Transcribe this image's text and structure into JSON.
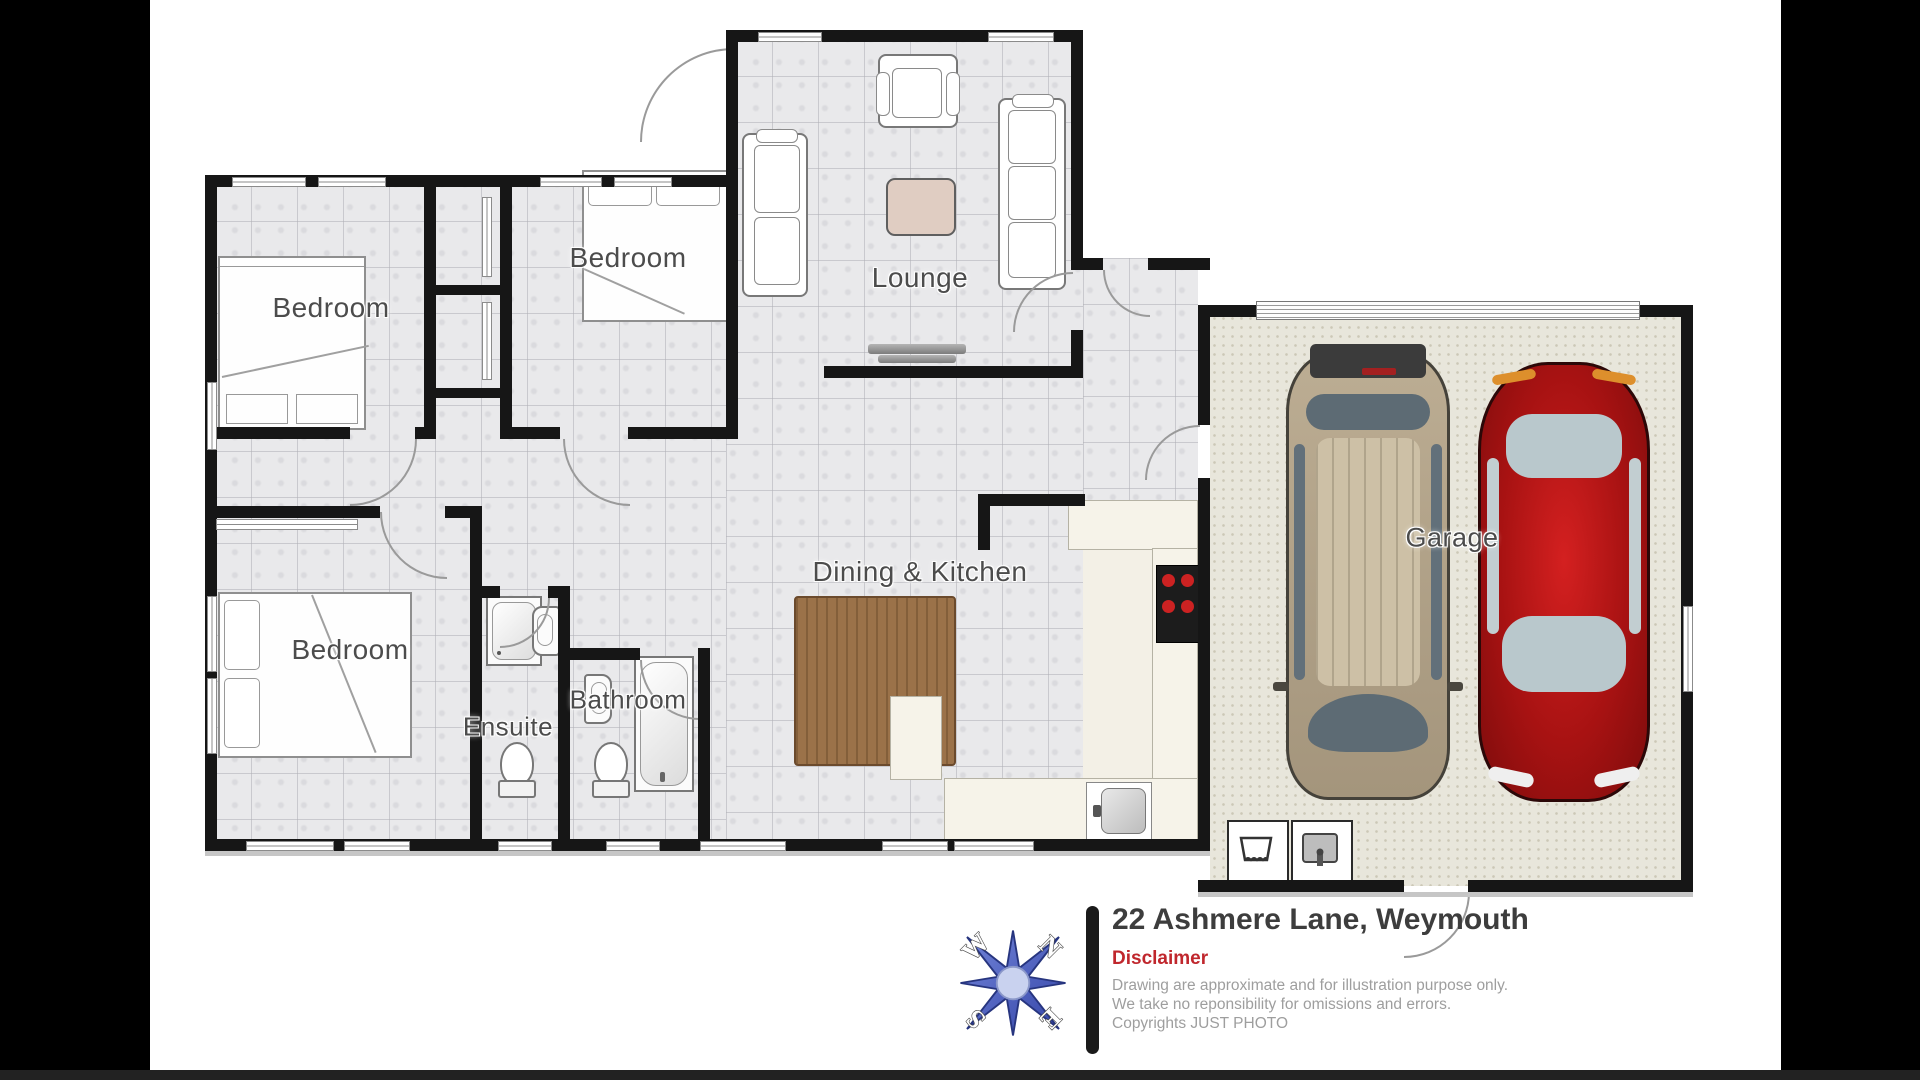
{
  "floorplan": {
    "rooms": [
      {
        "id": "bedroom-1",
        "label": "Bedroom"
      },
      {
        "id": "bedroom-2",
        "label": "Bedroom"
      },
      {
        "id": "lounge",
        "label": "Lounge"
      },
      {
        "id": "bedroom-3",
        "label": "Bedroom"
      },
      {
        "id": "ensuite",
        "label": "Ensuite"
      },
      {
        "id": "bathroom",
        "label": "Bathroom"
      },
      {
        "id": "dining-kitchen",
        "label": "Dining & Kitchen"
      },
      {
        "id": "garage",
        "label": "Garage"
      }
    ]
  },
  "compass": {
    "n": "N",
    "e": "E",
    "s": "S",
    "w": "W"
  },
  "footer": {
    "address": "22 Ashmere Lane, Weymouth",
    "disclaimer_heading": "Disclaimer",
    "disclaimer_lines": [
      "Drawing are approximate and for illustration purpose only.",
      "We take no reponsibility for omissions and errors.",
      "Copyrights JUST PHOTO"
    ]
  },
  "colors": {
    "accent_red": "#c0272d",
    "compass_blue": "#4a5cc4",
    "wall": "#161616",
    "car_red": "#b31414",
    "car_tan": "#b5a68c"
  }
}
